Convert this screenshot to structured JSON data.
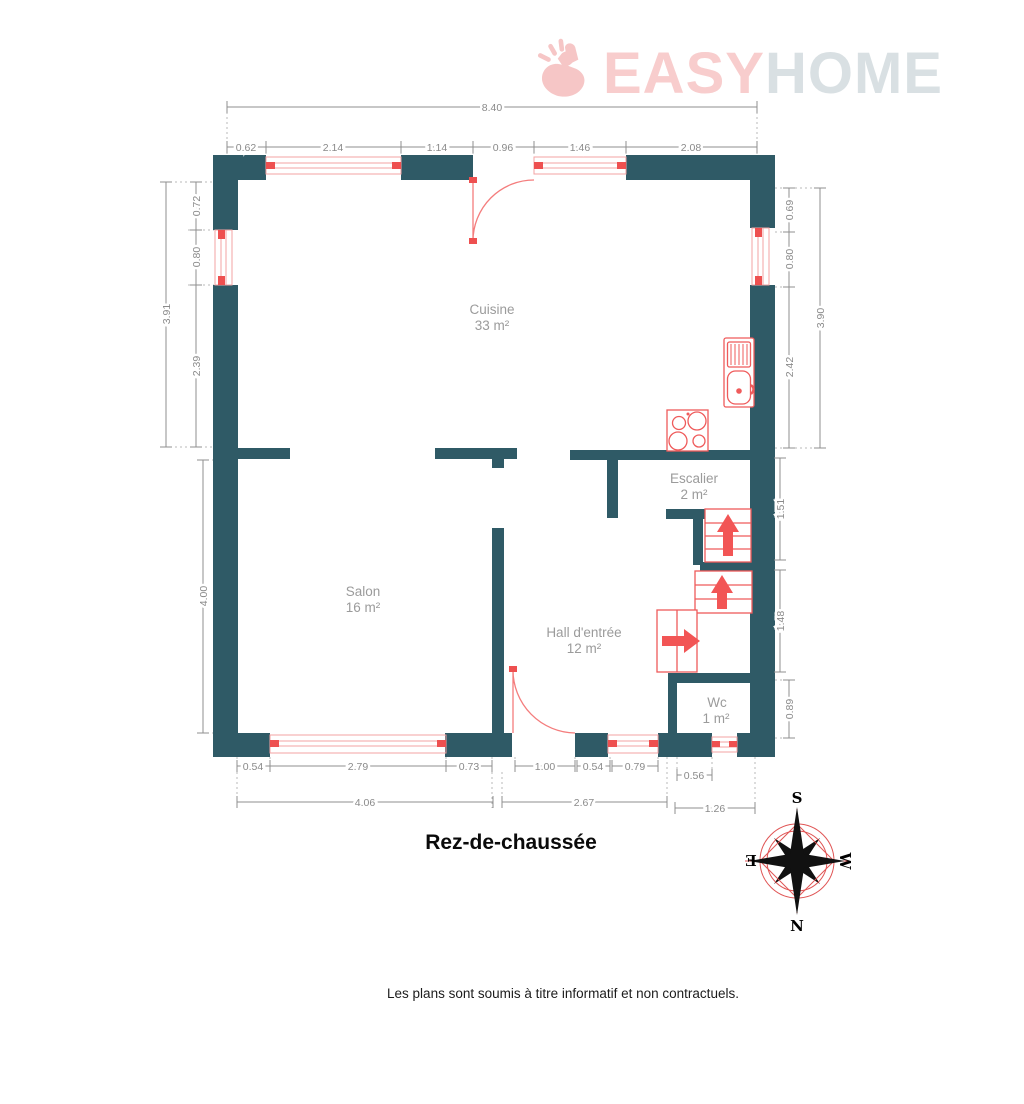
{
  "logo": {
    "easy": "EASY",
    "home": "HOME",
    "easy_color": "#f8cdcd",
    "home_color": "#d9e0e3",
    "hand_icon": "snap-hand-icon"
  },
  "title": "Rez-de-chaussée",
  "disclaimer": "Les plans sont soumis à titre informatif et non contractuels.",
  "plan": {
    "colors": {
      "wall": "#2f5a66",
      "fixture": "#ef5b5b",
      "arrow": "#f25555",
      "window_line": "#f3a3a3",
      "window_cap": "#ee5050",
      "dim_line": "#8f8f8f"
    },
    "rooms": {
      "cuisine": {
        "name": "Cuisine",
        "area": "33 m²"
      },
      "salon": {
        "name": "Salon",
        "area": "16 m²"
      },
      "hall": {
        "name": "Hall d'entrée",
        "area": "12 m²"
      },
      "escalier": {
        "name": "Escalier",
        "area": "2 m²"
      },
      "wc": {
        "name": "Wc",
        "area": "1 m²"
      }
    },
    "dims": {
      "top_total": "8.40",
      "top": [
        "0.62",
        "2.14",
        "1.14",
        "0.96",
        "1.46",
        "2.08"
      ],
      "left_total": "3.91",
      "left": [
        "0.72",
        "0.80",
        "2.39"
      ],
      "left_lower": "4.00",
      "right": [
        "0.69",
        "0.80",
        "2.42"
      ],
      "right_total": "3.90",
      "right_lower": [
        "1.51",
        "1.48",
        "0.89"
      ],
      "bottom_inner": [
        "0.54",
        "2.79",
        "0.73",
        "1.00",
        "0.54",
        "0.79",
        "0.56"
      ],
      "bottom_outer": [
        "4.06",
        "2.67",
        "1.26"
      ]
    },
    "compass": {
      "n": "N",
      "s": "S",
      "e": "E",
      "w": "W"
    }
  }
}
